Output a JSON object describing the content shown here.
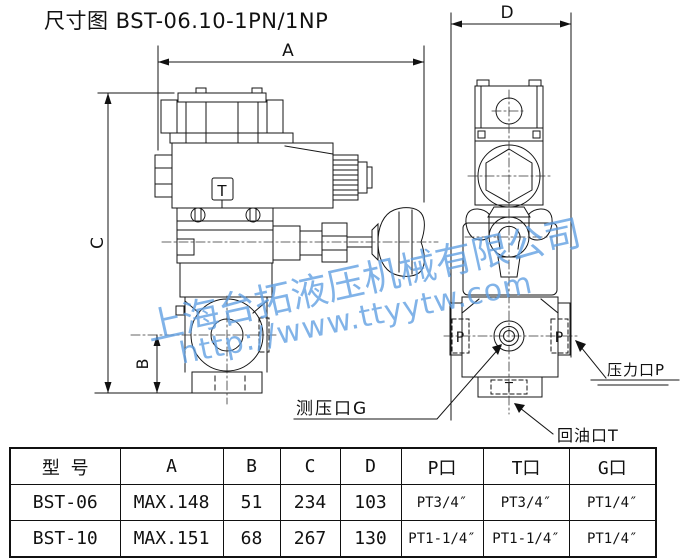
{
  "title": "尺寸图 BST-06.10-1PN/1NP",
  "drawing": {
    "dims": {
      "a": "A",
      "b": "B",
      "c": "C",
      "d": "D"
    },
    "marks": {
      "solenoid_t": "T",
      "port_p_left": "P",
      "port_p_right": "P",
      "port_t_bottom": "T"
    },
    "callouts": {
      "gauge": "测压口G",
      "pressure": "压力口P",
      "return": "回油口T"
    },
    "line_color": "#161616"
  },
  "watermark": {
    "company": "上海台拓液压机械有限公司",
    "url": "http://www.ttyytw.com",
    "color": "#5d9ee2"
  },
  "table": {
    "headers": [
      "型 号",
      "A",
      "B",
      "C",
      "D",
      "P口",
      "T口",
      "G口"
    ],
    "rows": [
      [
        "BST-06",
        "MAX.148",
        "51",
        "234",
        "103",
        "PT3/4″",
        "PT3/4″",
        "PT1/4″"
      ],
      [
        "BST-10",
        "MAX.151",
        "68",
        "267",
        "130",
        "PT1-1/4″",
        "PT1-1/4″",
        "PT1/4″"
      ]
    ]
  }
}
